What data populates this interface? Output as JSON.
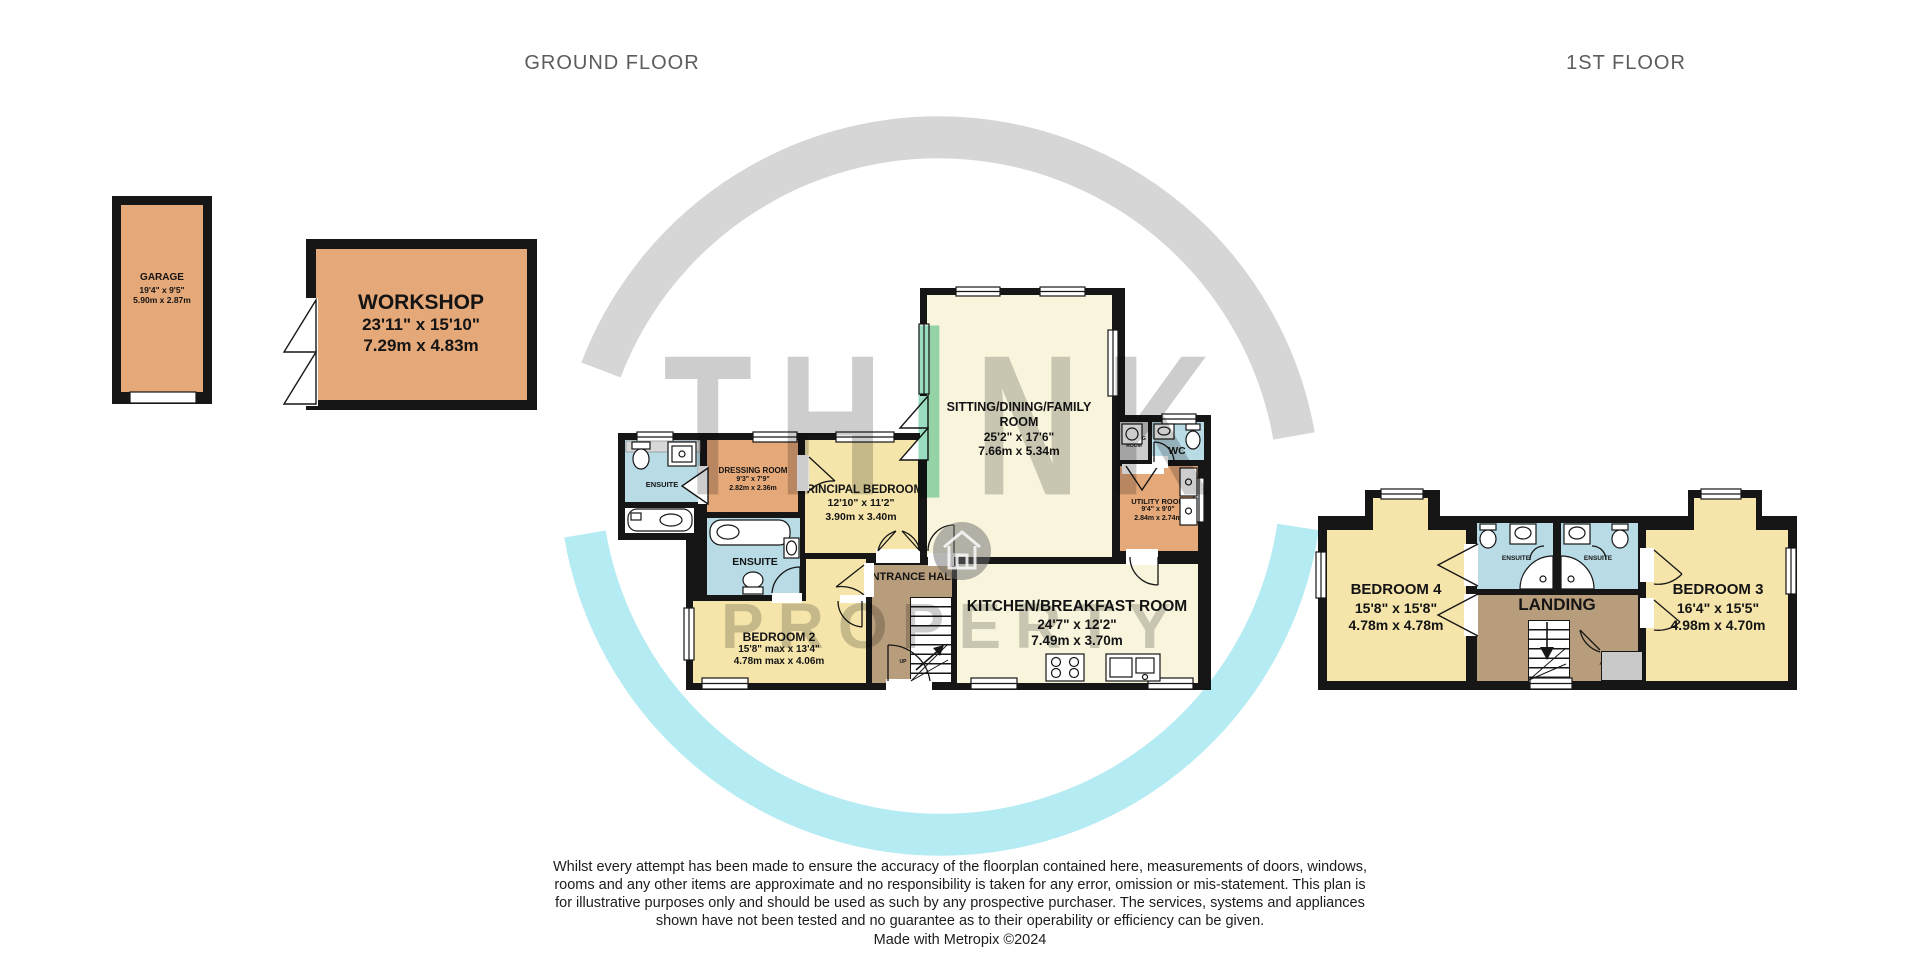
{
  "headers": {
    "ground": "GROUND FLOOR",
    "first": "1ST FLOOR"
  },
  "watermark": {
    "t1": "TH",
    "t2": "I",
    "t3": "NK",
    "line2": "PROPERTY"
  },
  "colors": {
    "wall": "#161616",
    "orange": "#e5a878",
    "yellow": "#f5e5ab",
    "cream": "#f9f5dd",
    "blue": "#b9dbe5",
    "brown": "#b79d7b",
    "gray_room": "#cccccc",
    "accent_teal": "#99dcc0",
    "arc_cyan": "#b5ebf3",
    "arc_gray": "#d6d6d6"
  },
  "outbuildings": {
    "garage": {
      "name": "GARAGE",
      "ft": "19'4\" x 9'5\"",
      "m": "5.90m x 2.87m"
    },
    "workshop": {
      "name": "WORKSHOP",
      "ft": "23'11\" x 15'10\"",
      "m": "7.29m x 4.83m"
    }
  },
  "gf": {
    "ensuite1": {
      "name": "ENSUITE"
    },
    "dressing": {
      "name": "DRESSING ROOM",
      "ft": "9'3\" x 7'9\"",
      "m": "2.82m x 2.36m"
    },
    "principal": {
      "name": "PRINCIPAL BEDROOM",
      "ft": "12'10\" x 11'2\"",
      "m": "3.90m x 3.40m"
    },
    "sitting": {
      "name1": "SITTING/DINING/FAMILY",
      "name2": "ROOM",
      "ft": "25'2\" x 17'6\"",
      "m": "7.66m x 5.34m"
    },
    "washing": {
      "name1": "WASHING",
      "name2": "ROOM"
    },
    "wc": {
      "name": "WC"
    },
    "utility": {
      "name": "UTILITY ROOM",
      "ft": "9'4\" x 9'0\"",
      "m": "2.84m x 2.74m"
    },
    "ensuite2": {
      "name": "ENSUITE"
    },
    "bedroom2": {
      "name": "BEDROOM 2",
      "ft": "15'8\" max x 13'4\"",
      "m": "4.78m max x 4.06m"
    },
    "entrance": {
      "name": "ENTRANCE HALL"
    },
    "kitchen": {
      "name": "KITCHEN/BREAKFAST ROOM",
      "ft": "24'7\" x 12'2\"",
      "m": "7.49m x 3.70m"
    },
    "up": "UP"
  },
  "ff": {
    "bedroom4": {
      "name": "BEDROOM 4",
      "ft": "15'8\" x 15'8\"",
      "m": "4.78m x 4.78m"
    },
    "ensuite_a": {
      "name": "ENSUITE"
    },
    "ensuite_b": {
      "name": "ENSUITE"
    },
    "landing": {
      "name": "LANDING"
    },
    "airing": {
      "name": "AIRING CUPBOARD"
    },
    "bedroom3": {
      "name": "BEDROOM 3",
      "ft": "16'4\" x 15'5\"",
      "m": "4.98m x 4.70m"
    }
  },
  "footer": {
    "disclaimer": "Whilst every attempt has been made to ensure the accuracy of the floorplan contained here, measurements of doors, windows, rooms and any other items are approximate and no responsibility is taken for any error, omission or mis-statement. This plan is for illustrative purposes only and should be used as such by any prospective purchaser. The services, systems and appliances shown have not been tested and no guarantee as to their operability or efficiency can be given.",
    "credit": "Made with Metropix ©2024"
  }
}
